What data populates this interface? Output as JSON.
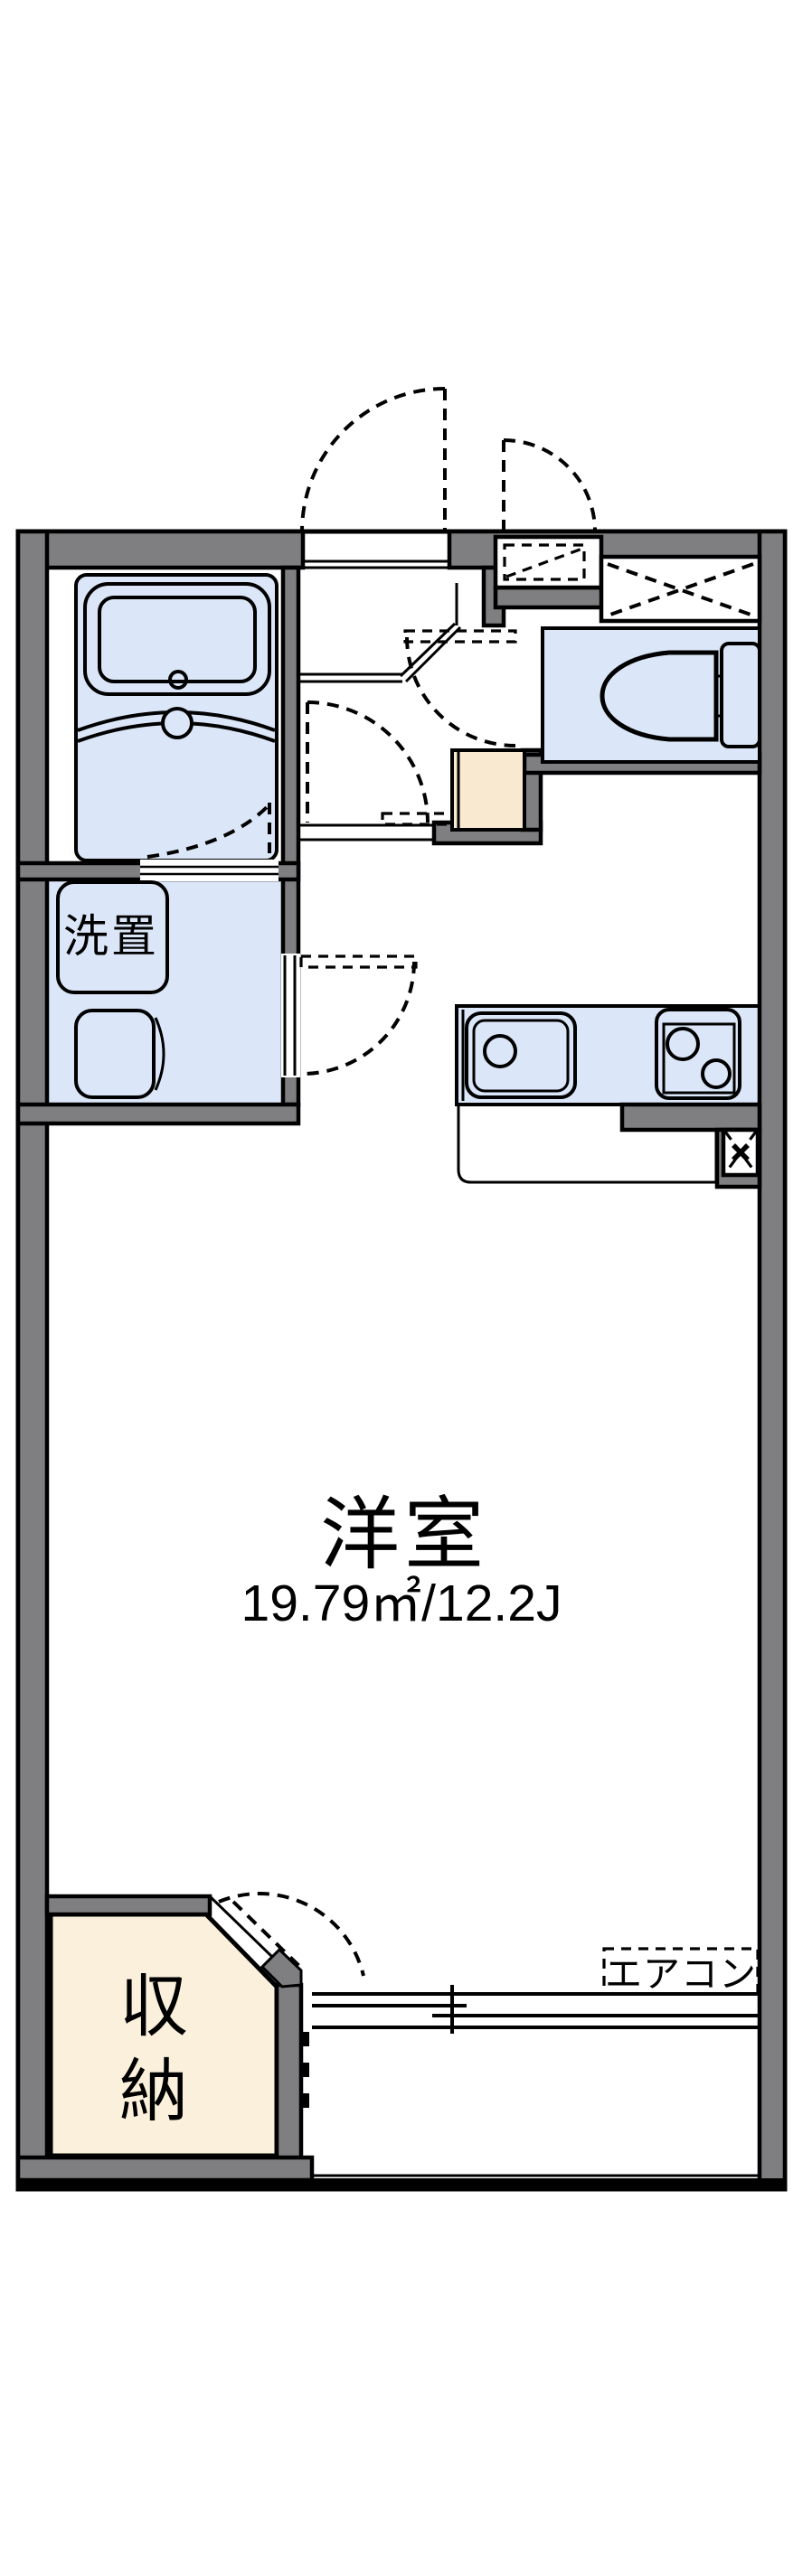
{
  "labels": {
    "room": "洋室",
    "room_area": "19.79㎡/12.2J",
    "washer": "洗置",
    "closet": "収納",
    "closet_chars": [
      "収",
      "納"
    ],
    "aircon": "エアコン"
  },
  "colors": {
    "wall": "#7f7f82",
    "floor": "#dbe7f8",
    "closet_beige": "#faf0dc",
    "entry_beige": "#f9e9d0",
    "outline": "#000000",
    "background": "#ffffff"
  }
}
